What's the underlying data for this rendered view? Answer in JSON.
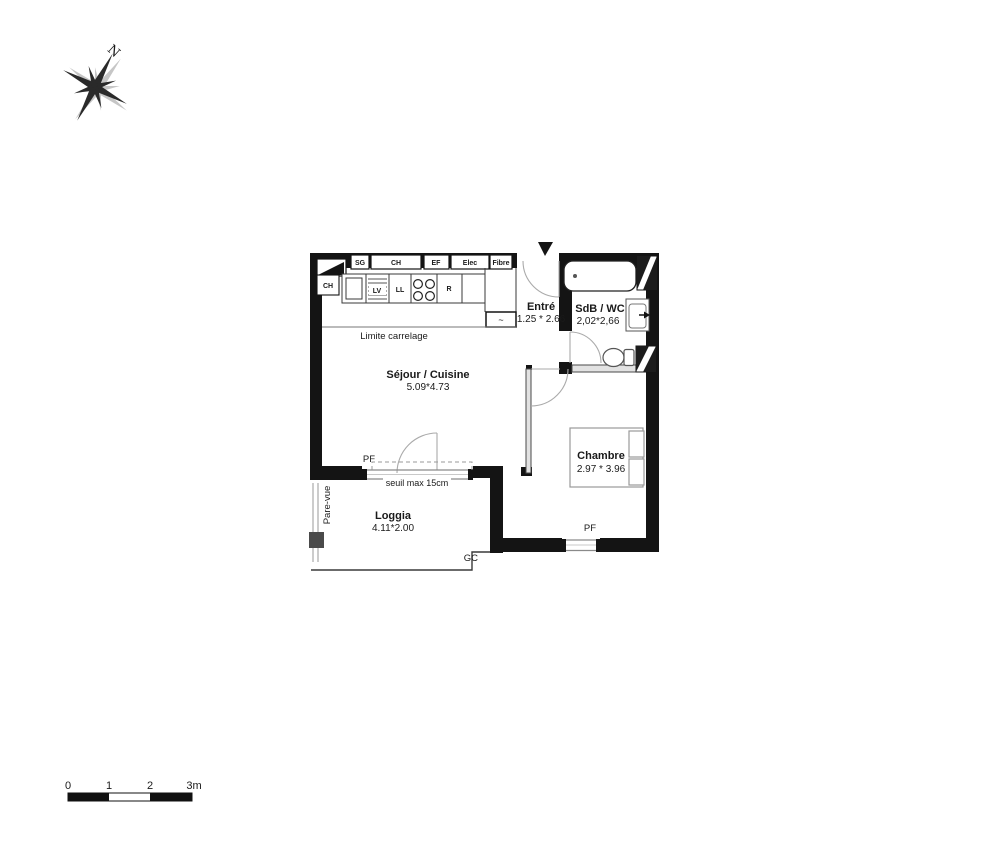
{
  "compass": {
    "north": "N"
  },
  "entry_marker": "entrance-arrow",
  "rooms": {
    "sejour": {
      "name": "Séjour / Cuisine",
      "dims": "5.09*4.73"
    },
    "entree": {
      "name": "Entré",
      "dims": "1.25 * 2.66"
    },
    "sdb": {
      "name": "SdB / WC",
      "dims": "2,02*2,66"
    },
    "chambre": {
      "name": "Chambre",
      "dims": "2.97 * 3.96"
    },
    "loggia": {
      "name": "Loggia",
      "dims": "4.11*2.00"
    }
  },
  "wall_boxes": {
    "sg": "SG",
    "ch": "CH",
    "ef": "EF",
    "elec": "Elec",
    "fibre": "Fibre"
  },
  "kitchen": {
    "ch": "CH",
    "lv": "LV",
    "ll": "LL",
    "r": "R",
    "vmc": "~"
  },
  "annotations": {
    "limite_carrelage": "Limite carrelage",
    "seuil": "seuil max 15cm",
    "pf_sejour": "PF",
    "pf_chambre": "PF",
    "pare_vue": "Pare-vue",
    "gc": "GC"
  },
  "scale_bar": {
    "t0": "0",
    "t1": "1",
    "t2": "2",
    "t3": "3m"
  },
  "colors": {
    "wall": "#141414",
    "thin_line": "#8a8a8a",
    "door_arc": "#aaaaaa",
    "post_gray": "#4a4a4a"
  }
}
